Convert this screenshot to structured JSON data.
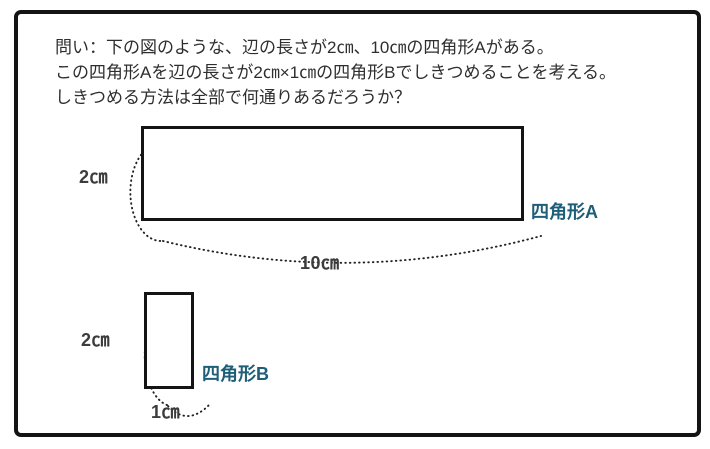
{
  "question": {
    "lines": [
      "問い：下の図のような、辺の長さが2㎝、10㎝の四角形Aがある。",
      "この四角形Aを辺の長さが2㎝×1㎝の四角形Bでしきつめることを考える。",
      "しきつめる方法は全部で何通りあるだろうか？"
    ]
  },
  "diagram": {
    "rect_a": {
      "name_label": "四角形A",
      "height_label": "2㎝",
      "width_label": "10㎝"
    },
    "rect_b": {
      "name_label": "四角形B",
      "height_label": "2㎝",
      "width_label": "1㎝"
    }
  },
  "colors": {
    "shape_label_blue": "#1f5e78",
    "outline_black": "#141414",
    "body_text": "#2e2e2e",
    "dimension_text": "#3c3c3c"
  }
}
